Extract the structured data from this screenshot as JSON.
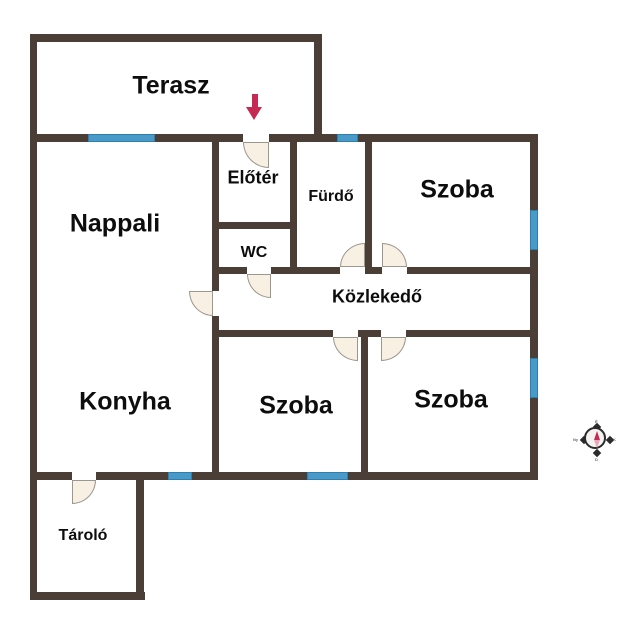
{
  "palette": {
    "wall": "#4a3e36",
    "window_fill": "#4a9ac9",
    "window_border": "#2f7fae",
    "door_fill": "#f7f0e3",
    "door_border": "#9b968e",
    "label": "#0d0d0d",
    "arrow": "#c62a52"
  },
  "rooms": [
    {
      "name": "terasz",
      "label": "Terasz",
      "x": 171,
      "y": 86,
      "size": "lg"
    },
    {
      "name": "nappali",
      "label": "Nappali",
      "x": 115,
      "y": 224,
      "size": "lg"
    },
    {
      "name": "eloter",
      "label": "Előtér",
      "x": 253,
      "y": 178,
      "size": "md"
    },
    {
      "name": "furdo",
      "label": "Fürdő",
      "x": 331,
      "y": 197,
      "size": "sm"
    },
    {
      "name": "szoba-1",
      "label": "Szoba",
      "x": 457,
      "y": 190,
      "size": "lg"
    },
    {
      "name": "wc",
      "label": "WC",
      "x": 254,
      "y": 253,
      "size": "sm"
    },
    {
      "name": "kozlekedo",
      "label": "Közlekedő",
      "x": 377,
      "y": 297,
      "size": "md"
    },
    {
      "name": "konyha",
      "label": "Konyha",
      "x": 125,
      "y": 402,
      "size": "lg"
    },
    {
      "name": "szoba-2",
      "label": "Szoba",
      "x": 296,
      "y": 406,
      "size": "lg"
    },
    {
      "name": "szoba-3",
      "label": "Szoba",
      "x": 451,
      "y": 400,
      "size": "lg"
    },
    {
      "name": "tarolo",
      "label": "Tároló",
      "x": 83,
      "y": 536,
      "size": "sm"
    }
  ],
  "walls": [
    {
      "name": "terasz-top",
      "rect": [
        30,
        34,
        292,
        8
      ]
    },
    {
      "name": "outer-left",
      "rect": [
        30,
        34,
        7,
        446
      ]
    },
    {
      "name": "terasz-right",
      "rect": [
        314,
        34,
        8,
        100
      ]
    },
    {
      "name": "main-top",
      "rect": [
        30,
        134,
        508,
        8
      ]
    },
    {
      "name": "outer-right",
      "rect": [
        530,
        134,
        8,
        346
      ]
    },
    {
      "name": "outer-bottom",
      "rect": [
        30,
        472,
        508,
        8
      ]
    },
    {
      "name": "tarolo-left",
      "rect": [
        30,
        480,
        7,
        120
      ]
    },
    {
      "name": "tarolo-bottom",
      "rect": [
        30,
        592,
        115,
        8
      ]
    },
    {
      "name": "tarolo-right",
      "rect": [
        136,
        480,
        8,
        120
      ]
    },
    {
      "name": "center-vertical",
      "rect": [
        212,
        142,
        7,
        330
      ]
    },
    {
      "name": "eloter-furdo",
      "rect": [
        290,
        142,
        7,
        132
      ]
    },
    {
      "name": "eloter-wc",
      "rect": [
        219,
        222,
        71,
        7
      ]
    },
    {
      "name": "szoba1-left",
      "rect": [
        365,
        142,
        7,
        132
      ]
    },
    {
      "name": "kozlekedo-top",
      "rect": [
        219,
        267,
        311,
        7
      ]
    },
    {
      "name": "kozlekedo-bottom",
      "rect": [
        219,
        330,
        311,
        7
      ]
    },
    {
      "name": "szoba-divider",
      "rect": [
        361,
        330,
        7,
        142
      ]
    }
  ],
  "openings": [
    {
      "name": "entrance",
      "rect": [
        243,
        134,
        26,
        8
      ]
    },
    {
      "name": "nappali",
      "rect": [
        212,
        291,
        7,
        25
      ]
    },
    {
      "name": "wc",
      "rect": [
        247,
        267,
        24,
        7
      ]
    },
    {
      "name": "furdo",
      "rect": [
        340,
        267,
        25,
        7
      ]
    },
    {
      "name": "szoba-1",
      "rect": [
        382,
        267,
        25,
        7
      ]
    },
    {
      "name": "szoba-2",
      "rect": [
        333,
        330,
        25,
        7
      ]
    },
    {
      "name": "szoba-3",
      "rect": [
        381,
        330,
        25,
        7
      ]
    },
    {
      "name": "tarolo",
      "rect": [
        72,
        472,
        24,
        8
      ]
    }
  ],
  "windows": [
    {
      "name": "nappali-top",
      "rect": [
        88,
        134,
        67,
        8
      ]
    },
    {
      "name": "furdo-top",
      "rect": [
        337,
        134,
        21,
        8
      ]
    },
    {
      "name": "szoba1-right",
      "rect": [
        530,
        210,
        8,
        40
      ]
    },
    {
      "name": "szoba3-right",
      "rect": [
        530,
        358,
        8,
        40
      ]
    },
    {
      "name": "konyha-bottom",
      "rect": [
        168,
        472,
        24,
        8
      ]
    },
    {
      "name": "szoba2-bottom",
      "rect": [
        307,
        472,
        41,
        8
      ]
    }
  ],
  "doors": [
    {
      "name": "entrance",
      "rect": [
        243,
        142,
        26,
        26
      ],
      "corner": "bl"
    },
    {
      "name": "nappali",
      "rect": [
        189,
        291,
        24,
        25
      ],
      "corner": "bl"
    },
    {
      "name": "wc",
      "rect": [
        247,
        274,
        24,
        24
      ],
      "corner": "bl"
    },
    {
      "name": "furdo",
      "rect": [
        340,
        243,
        25,
        24
      ],
      "corner": "tl"
    },
    {
      "name": "szoba-1",
      "rect": [
        382,
        243,
        25,
        24
      ],
      "corner": "tr"
    },
    {
      "name": "szoba-2",
      "rect": [
        333,
        337,
        25,
        24
      ],
      "corner": "bl"
    },
    {
      "name": "szoba-3",
      "rect": [
        381,
        337,
        25,
        24
      ],
      "corner": "br"
    },
    {
      "name": "tarolo",
      "rect": [
        72,
        480,
        24,
        24
      ],
      "corner": "br"
    }
  ],
  "entrance_arrow": {
    "stem": [
      252,
      94,
      6,
      14
    ],
    "head_x": 246,
    "head_y": 107
  },
  "compass": {
    "north": "É",
    "east": "K",
    "south": "D",
    "west": "Ny"
  }
}
